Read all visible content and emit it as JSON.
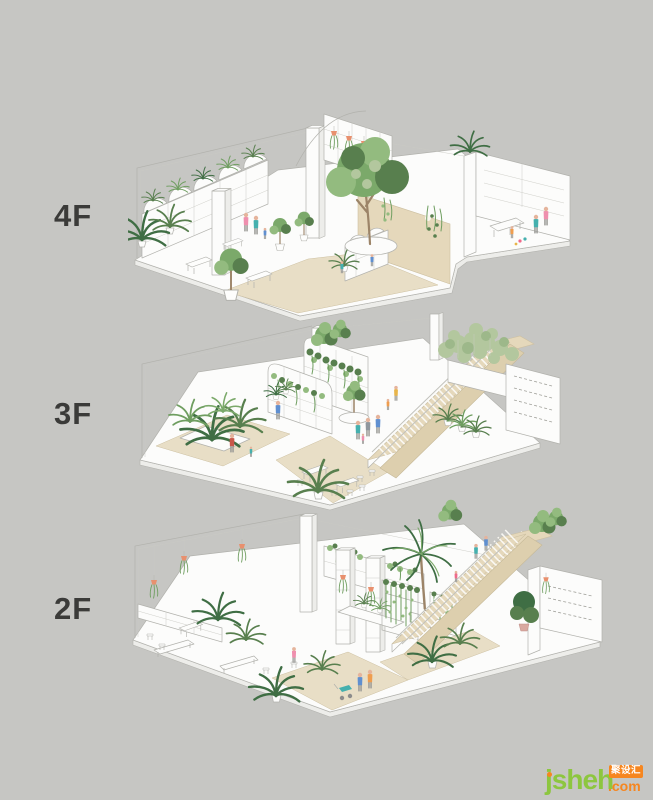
{
  "page": {
    "background_color": "#c6c6c3"
  },
  "floors": [
    {
      "id": "4f",
      "label": "4F",
      "alt": "Fourth-floor axonometric: arched bookshelf walls with plants, large central tree in round planter, tan partition wall with climbing vines, hanging coral planters, side reading room with table and figures"
    },
    {
      "id": "3f",
      "label": "3F",
      "alt": "Third-floor axonometric: curved vine-covered display walls, round tree planter, grand beige staircase with landing, bamboo planter box, shelf wall, cafe tables and figures"
    },
    {
      "id": "2f",
      "label": "2F",
      "alt": "Second-floor axonometric: central palm tree with vine curtains, beige staircase with people, shelving pillars with hanging orange pots, benches, potted ferns, stroller figures and side stockroom"
    }
  ],
  "watermark": {
    "brand": "jsheh",
    "badge": "聚设汇",
    "tld": ".com"
  },
  "palette": {
    "background": "#c6c6c3",
    "label_text": "#3b3b39",
    "wall_white": "#fcfcfb",
    "outline_gray": "#b2b2ad",
    "floor_beige": "#e8dec6",
    "stair_beige": "#e5d8bb",
    "plant_green": "#7ba96a",
    "plant_dark_green": "#3f6e44",
    "accent_coral": "#e8906e",
    "brand_green": "#8dc63f",
    "brand_orange": "#f6861f"
  }
}
